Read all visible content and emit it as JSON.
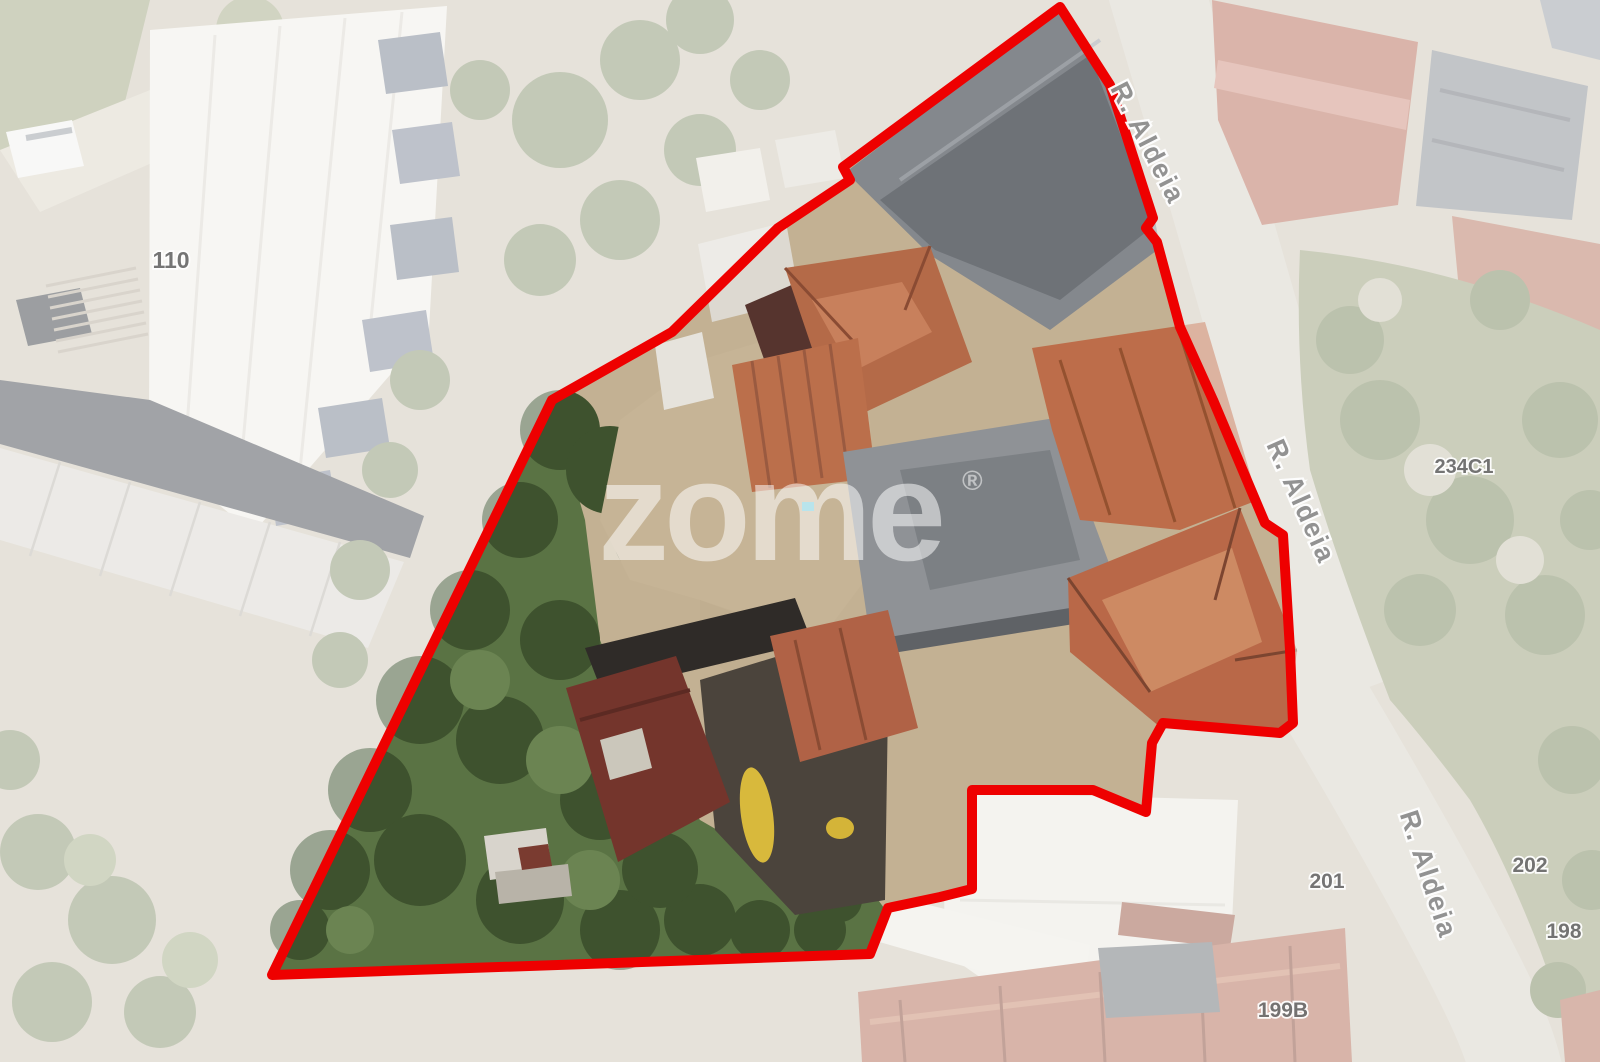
{
  "map": {
    "type": "satellite-aerial-view",
    "watermark_text": "zome",
    "watermark_reg": "®",
    "street_labels": [
      {
        "text": "R. Aldeia"
      },
      {
        "text": "R. Aldeia"
      },
      {
        "text": "R. Aldeia"
      }
    ],
    "address_labels": [
      {
        "text": "110"
      },
      {
        "text": "234C1"
      },
      {
        "text": "201"
      },
      {
        "text": "202"
      },
      {
        "text": "198"
      },
      {
        "text": "199B"
      }
    ],
    "boundary": {
      "color": "#ee0000",
      "points": "1060,7 1110,85 1153,218 1146,228 1157,242 1180,327 1213,400 1265,523 1283,535 1290,650 1293,723 1280,733 1163,723 1152,743 1146,812 1093,790 972,790 972,889 940,897 888,908 870,954 272,975 552,400 672,332 778,228 850,180 843,167"
    }
  }
}
